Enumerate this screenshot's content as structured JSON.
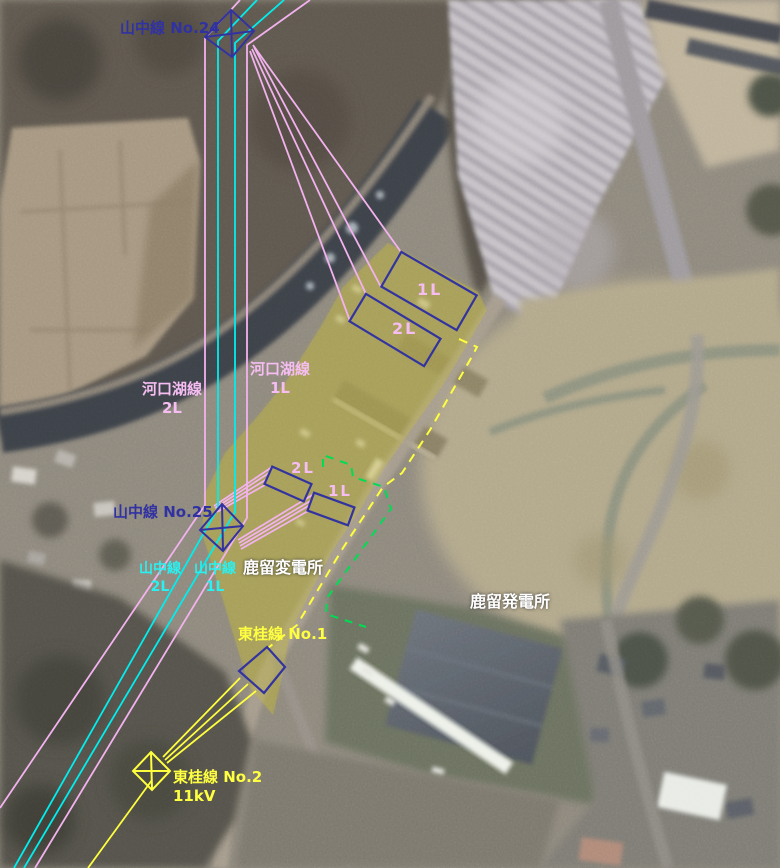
{
  "colors": {
    "pink_line": "#f2b2ee",
    "cyan_line": "#00eeee",
    "yellow_line": "#ffff3e",
    "green_dashed": "#00dd55",
    "navy_symbol": "#3333a0",
    "area_highlight": "#cdc229",
    "white_text": "#ffffff"
  },
  "labels": {
    "yamanaka_no24": "山中線 No.24",
    "yamanaka_no25": "山中線 No.25",
    "kawaguchiko_line_2l": {
      "name": "河口湖線",
      "circuit": "2L"
    },
    "kawaguchiko_line_1l": {
      "name": "河口湖線",
      "circuit": "1L"
    },
    "yamanaka_line_2l": {
      "name": "山中線",
      "circuit": "2L"
    },
    "yamanaka_line_1l": {
      "name": "山中線",
      "circuit": "1L"
    },
    "bay_large_1l": "1L",
    "bay_large_2l": "2L",
    "bay_small_2l": "2L",
    "bay_small_1l": "1L",
    "substation": "鹿留変電所",
    "power_plant": "鹿留発電所",
    "tokatsu_no1": "東桂線 No.1",
    "tokatsu_no2": "東桂線 No.2",
    "tokatsu_no2_voltage": "11kV"
  }
}
